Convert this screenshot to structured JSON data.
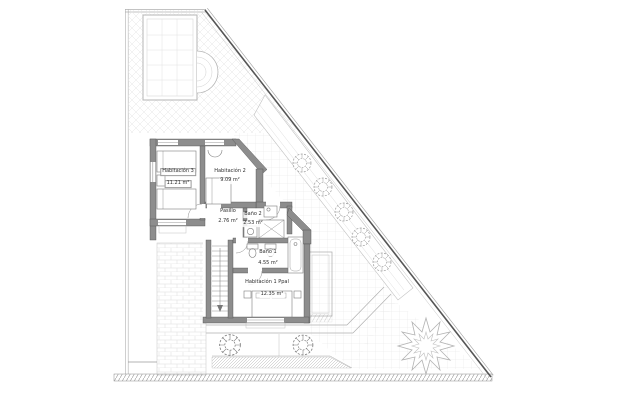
{
  "plan": {
    "rooms": [
      {
        "name": "Habitación 3",
        "area": "11.21 m²"
      },
      {
        "name": "Habitación 2",
        "area": "9.09 m²"
      },
      {
        "name": "Pasillo",
        "area": "2.76 m²"
      },
      {
        "name": "Baño 2",
        "area": "2.53 m²"
      },
      {
        "name": "Baño 1",
        "area": "4.55 m²"
      },
      {
        "name": "Habitación 1 Ppal",
        "area": "12.35 m²"
      }
    ],
    "features": {
      "pool": "swimming-pool",
      "shrubs": "garden-shrubs",
      "tree": "palm-tree",
      "stairs": "staircase"
    },
    "colors": {
      "wall_fill": "#8d8d8d",
      "boundary_line": "#555555",
      "light_line": "#c0c0c0",
      "hatch": "#e6e6e6",
      "text": "#2e2e2e"
    }
  }
}
